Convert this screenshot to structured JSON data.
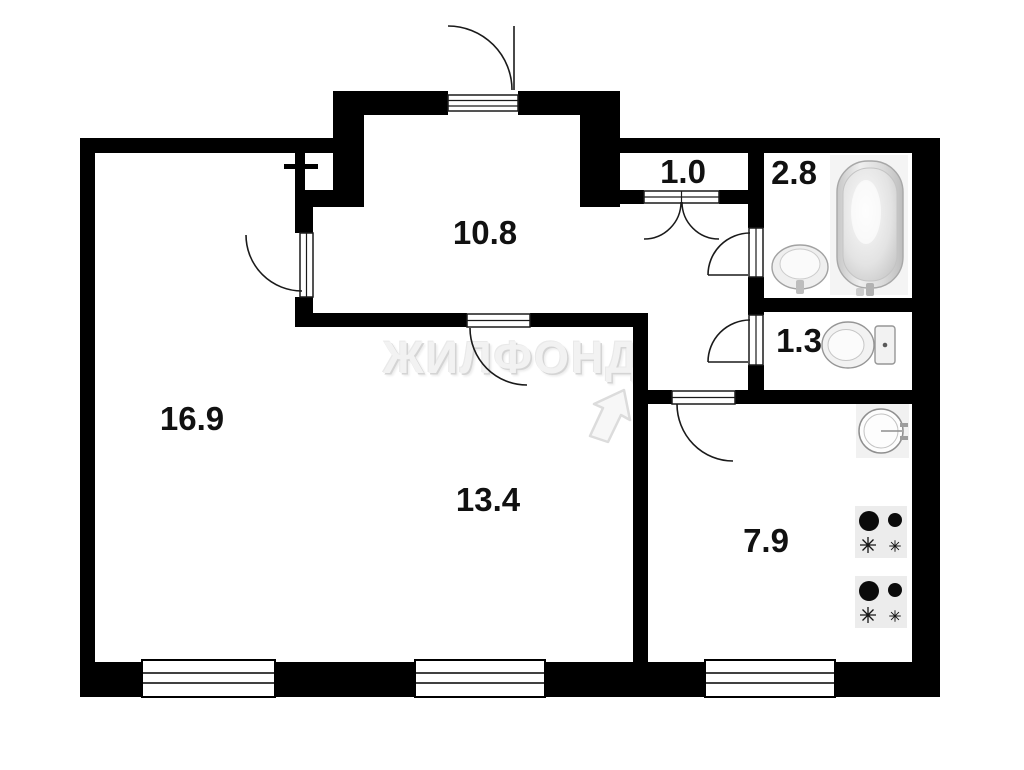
{
  "plan": {
    "watermark_text": "ЖИЛФОНД",
    "rooms": [
      {
        "key": "living-room",
        "area": "16.9"
      },
      {
        "key": "hallway",
        "area": "10.8"
      },
      {
        "key": "closet",
        "area": "1.0"
      },
      {
        "key": "bathroom",
        "area": "2.8"
      },
      {
        "key": "wc",
        "area": "1.3"
      },
      {
        "key": "bedroom",
        "area": "13.4"
      },
      {
        "key": "kitchen",
        "area": "7.9"
      }
    ],
    "colors": {
      "wall": "#000000",
      "background": "#ffffff",
      "watermark": "#f2f2f2"
    }
  }
}
